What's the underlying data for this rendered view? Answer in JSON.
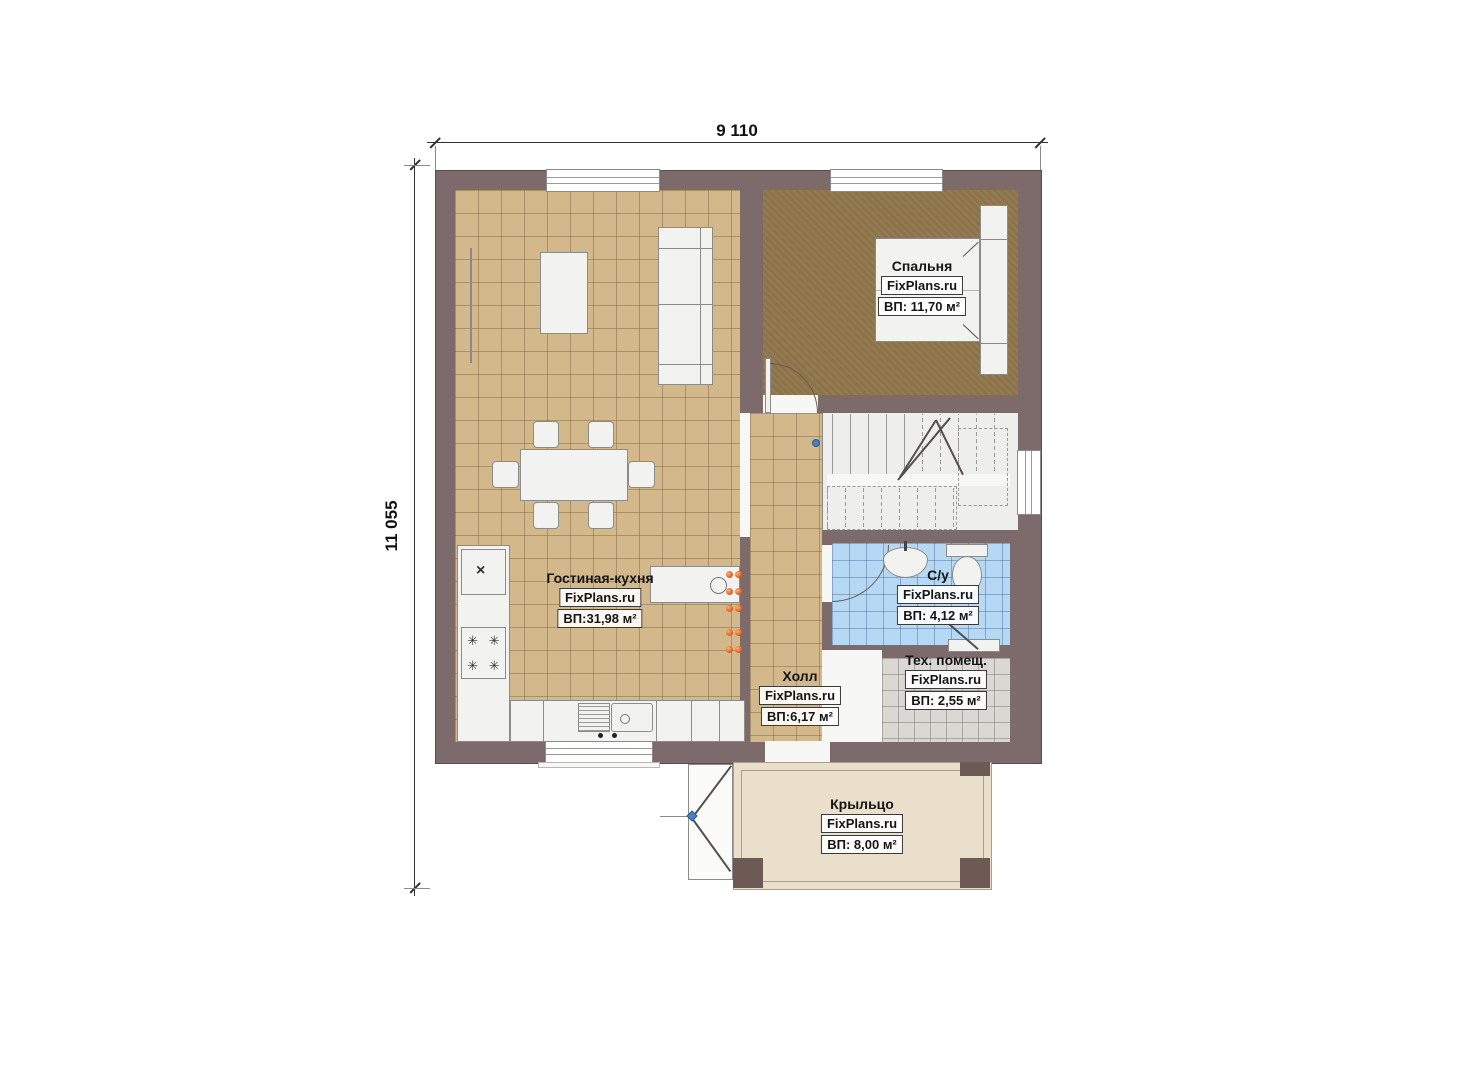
{
  "dimensions": {
    "width": "9 110",
    "height": "11 055"
  },
  "watermark": "FixPlans.ru",
  "rooms": [
    {
      "key": "bedroom",
      "name": "Спальня",
      "area": "ВП: 11,70 м²"
    },
    {
      "key": "living-kitchen",
      "name": "Гостиная-кухня",
      "area": "ВП:31,98 м²"
    },
    {
      "key": "bathroom",
      "name": "С/у",
      "area": "ВП: 4,12 м²"
    },
    {
      "key": "hall",
      "name": "Холл",
      "area": "ВП:6,17 м²"
    },
    {
      "key": "tech-room",
      "name": "Тех. помещ.",
      "area": "ВП: 2,55 м²"
    },
    {
      "key": "porch",
      "name": "Крыльцо",
      "area": "ВП: 8,00 м²"
    }
  ],
  "symbols": {
    "fridge": "×",
    "burner": "✳"
  },
  "colors": {
    "wall": "#7d6b6b",
    "tile_tan": "#d2b88b",
    "bedroom_floor": "#8c7349",
    "bath_tile": "#b5d8f4",
    "tech_tile": "#d9d8d3",
    "porch": "#e9dfca",
    "radiator_dot": "#e0601e",
    "marker_blue": "#4a7fc0"
  }
}
